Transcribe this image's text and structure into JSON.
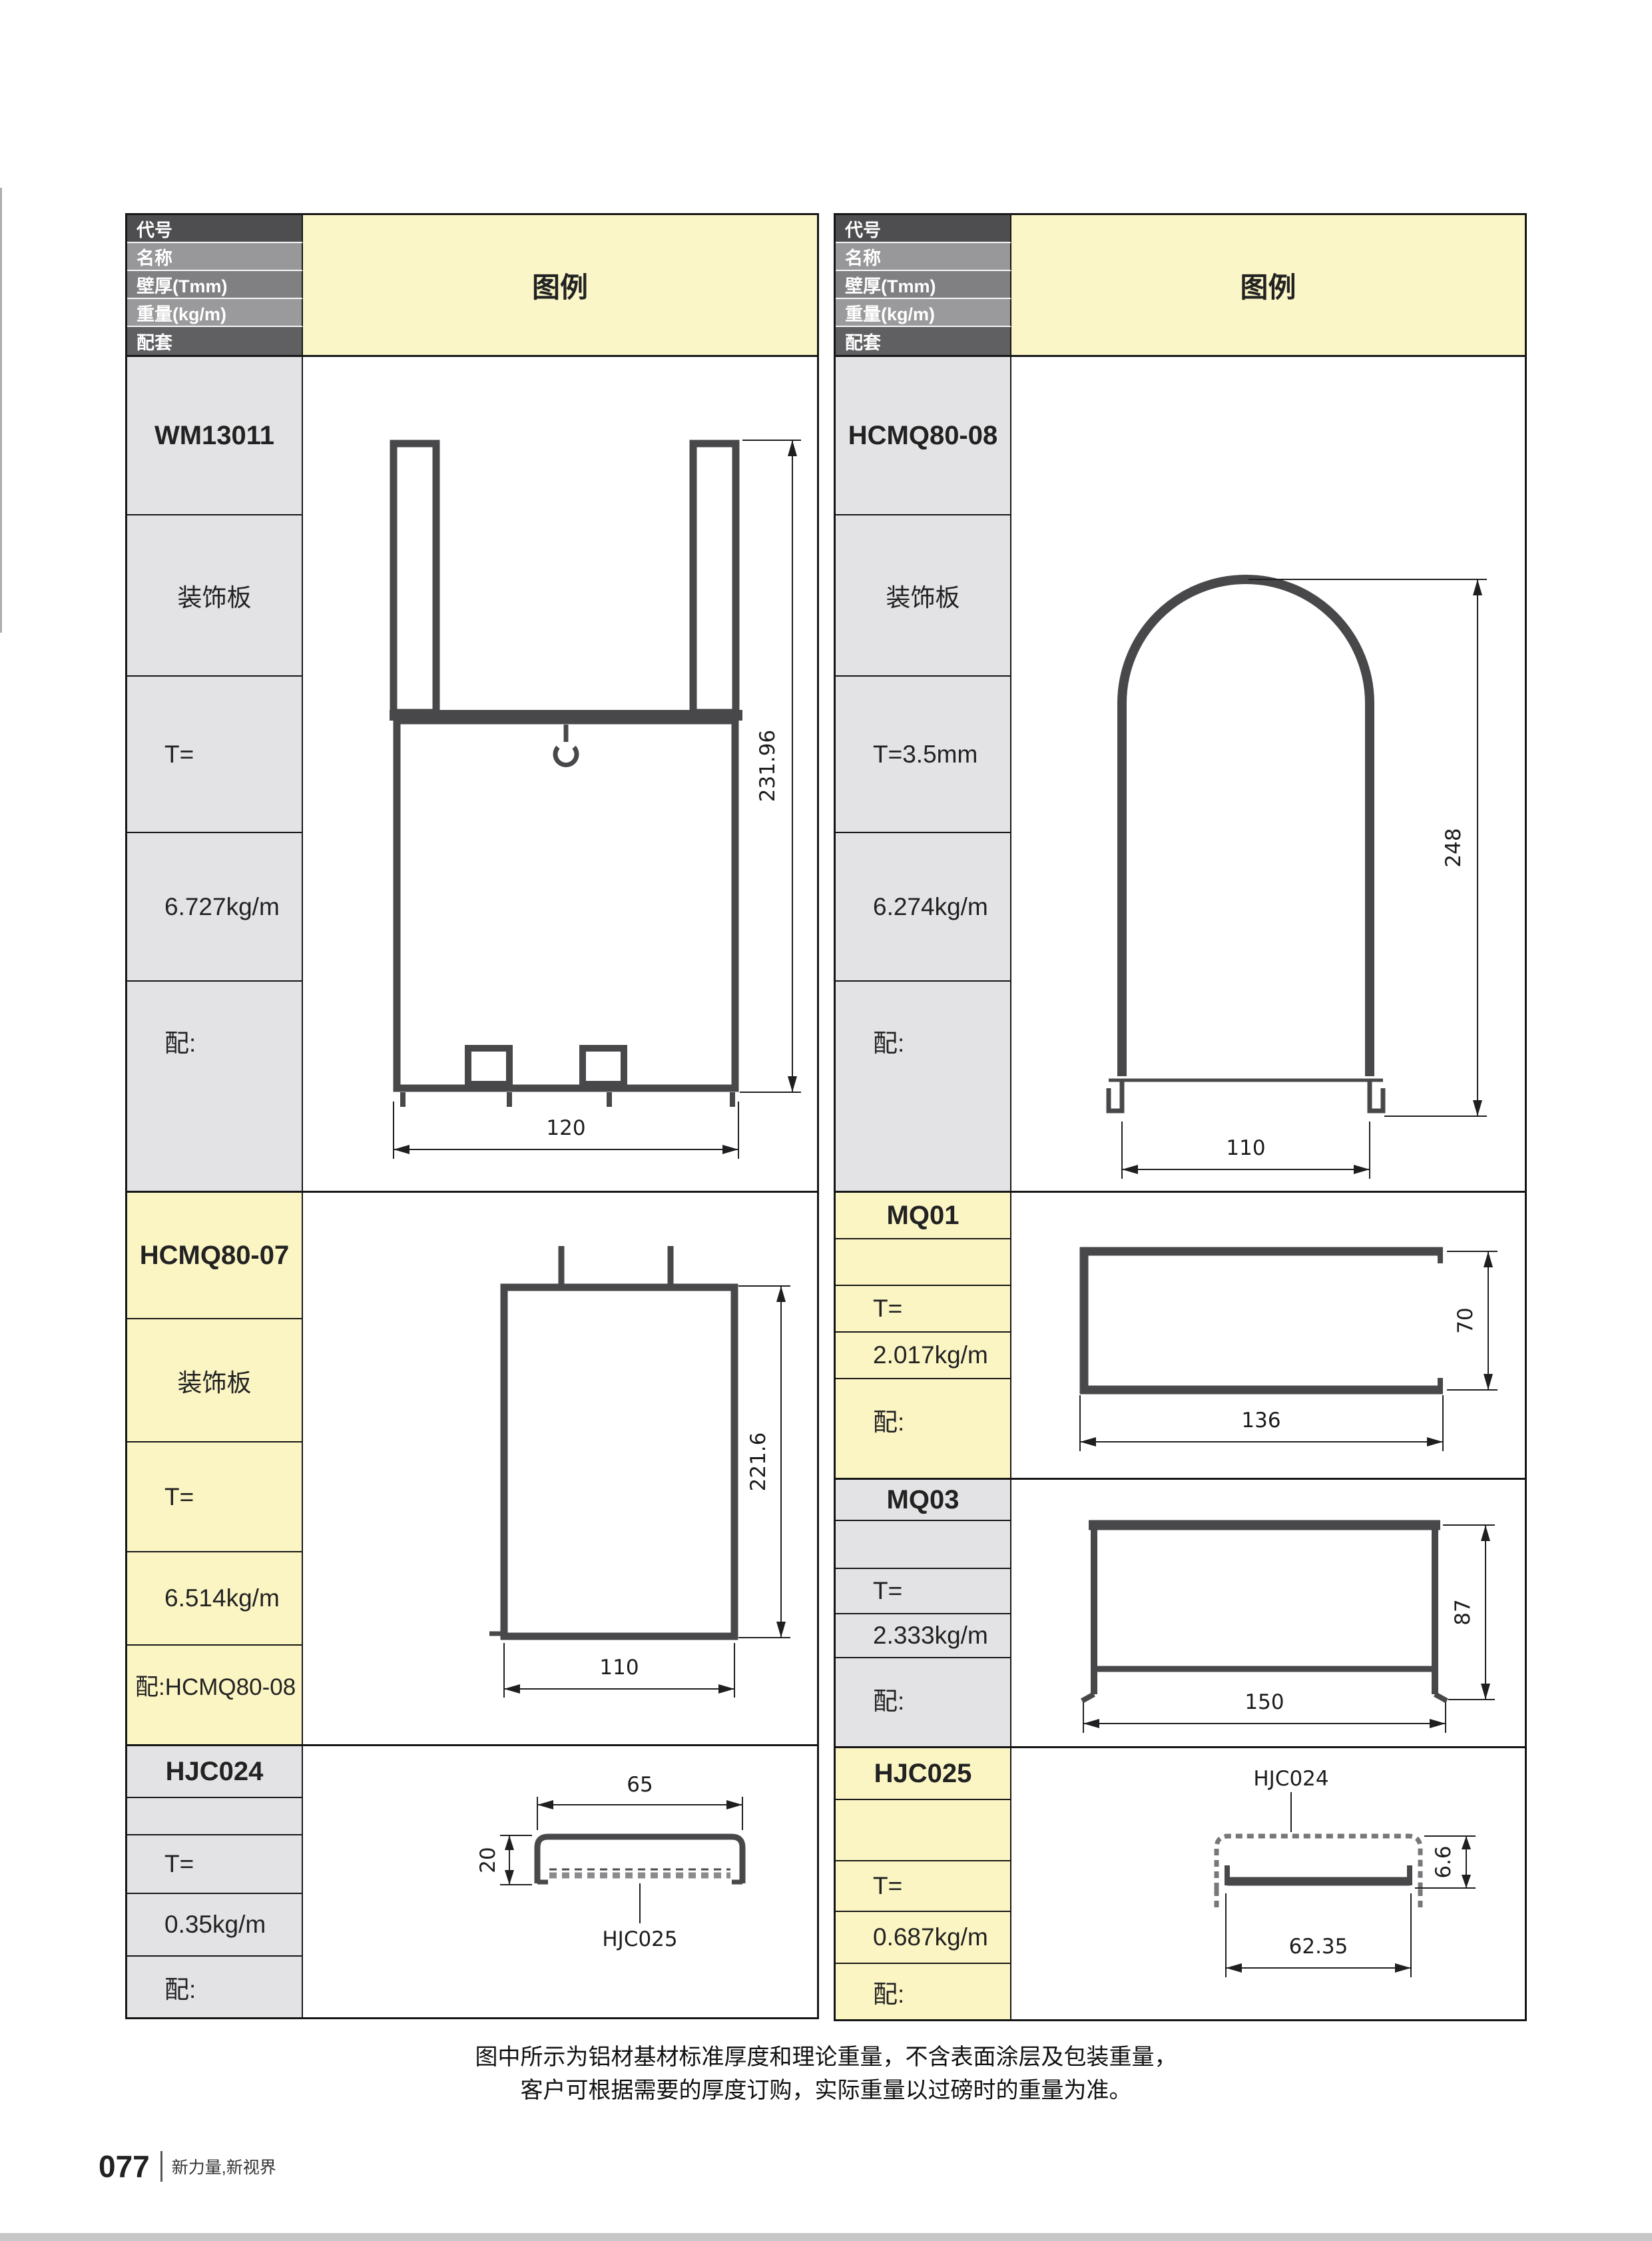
{
  "legend_label": "图例",
  "header_labels": [
    "代号",
    "名称",
    "壁厚(Tmm)",
    "重量(kg/m)",
    "配套"
  ],
  "colors": {
    "accent_yellow": "#FBF5C4",
    "label_gray": "#E3E3E5",
    "header_row_grays": [
      "#4E4E50",
      "#98989A",
      "#808083",
      "#9A9A9C",
      "#606063"
    ],
    "table_border": "#161616",
    "profile_stroke": "#48484B",
    "dimension_color": "#1F1F21",
    "bottom_bar_gray": "#C7C7C7"
  },
  "left_table": {
    "sections": [
      {
        "code": "WM13011",
        "name": "装饰板",
        "thickness": "T=",
        "weight": "6.727kg/m",
        "match": "配:",
        "figure": {
          "dims": {
            "height": "231.96",
            "width": "120"
          }
        }
      },
      {
        "code": "HCMQ80-07",
        "name": "装饰板",
        "thickness": "T=",
        "weight": "6.514kg/m",
        "match": "配:HCMQ80-08",
        "figure": {
          "dims": {
            "height": "221.6",
            "width": "110"
          }
        }
      },
      {
        "code": "HJC024",
        "name": "",
        "thickness": "T=",
        "weight": "0.35kg/m",
        "match": "配:",
        "figure": {
          "dims": {
            "width": "65",
            "height": "20"
          },
          "callout": "HJC025"
        }
      }
    ]
  },
  "right_table": {
    "sections": [
      {
        "code": "HCMQ80-08",
        "name": "装饰板",
        "thickness": "T=3.5mm",
        "weight": "6.274kg/m",
        "match": "配:",
        "figure": {
          "dims": {
            "height": "248",
            "width": "110"
          }
        }
      },
      {
        "code": "MQ01",
        "name": "",
        "thickness": "T=",
        "weight": "2.017kg/m",
        "match": "配:",
        "figure": {
          "dims": {
            "height": "70",
            "width": "136"
          }
        }
      },
      {
        "code": "MQ03",
        "name": "",
        "thickness": "T=",
        "weight": "2.333kg/m",
        "match": "配:",
        "figure": {
          "dims": {
            "height": "87",
            "width": "150"
          }
        }
      },
      {
        "code": "HJC025",
        "name": "",
        "thickness": "T=",
        "weight": "0.687kg/m",
        "match": "配:",
        "figure": {
          "dims": {
            "height": "6.6",
            "width": "62.35"
          },
          "callout": "HJC024"
        }
      }
    ]
  },
  "footer": {
    "note_line1": "图中所示为铝材基材标准厚度和理论重量，不含表面涂层及包装重量，",
    "note_line2": "客户可根据需要的厚度订购，实际重量以过磅时的重量为准。",
    "page_number": "077",
    "brand_slogan": "新力量,新视界"
  }
}
